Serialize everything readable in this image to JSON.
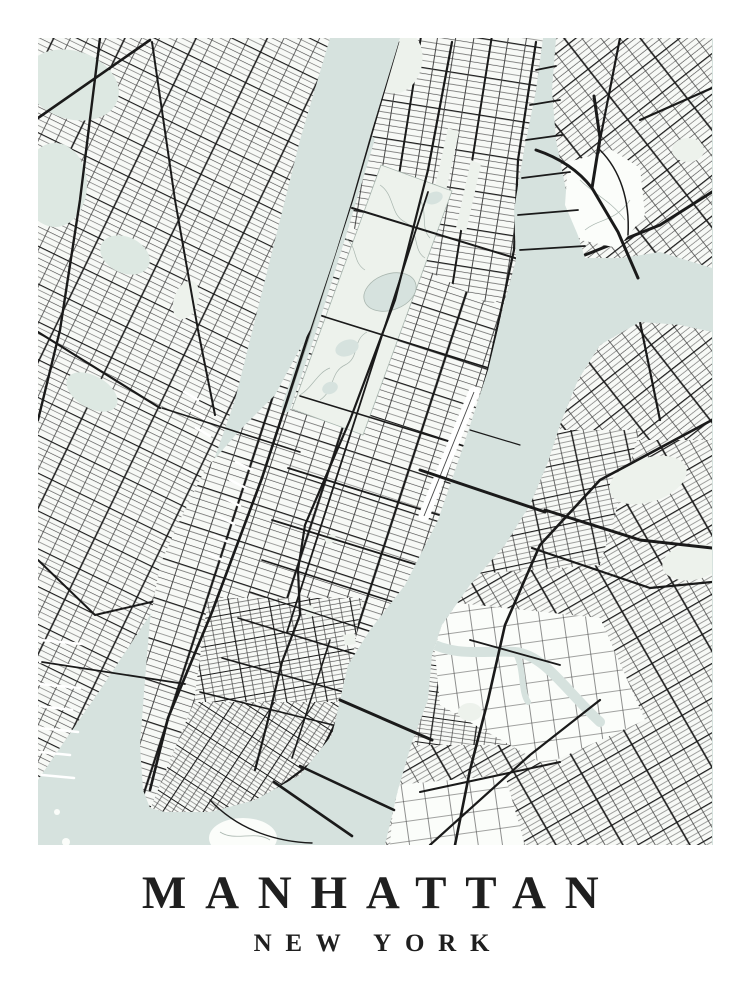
{
  "poster": {
    "title": "MANHATTAN",
    "subtitle": "NEW YORK"
  },
  "colors": {
    "background": "#ffffff",
    "water": "#d6e2de",
    "land": "#f7f9f6",
    "land_light": "#fbfdfa",
    "park": "#edf2ec",
    "marsh": "#dde8e2",
    "road": "#1a1a1a",
    "road_minor": "#474747",
    "contour": "#a9b6af",
    "text": "#1f1f1f"
  }
}
